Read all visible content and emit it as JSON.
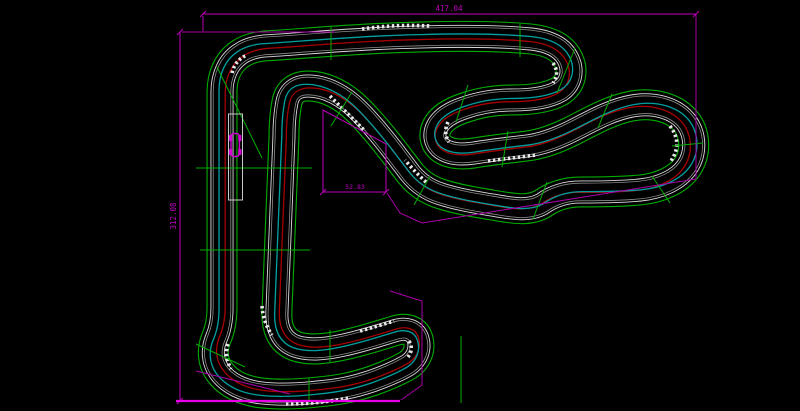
{
  "app": {
    "view": "cad-track-drawing",
    "description_of_view": "black CAD canvas with karting circuit plan, magenta dimensions and green section lines"
  },
  "dimensions": {
    "top_width_label": "417.04",
    "left_height_label": "312.08",
    "inner_width_label": "52.83"
  },
  "colors": {
    "background": "#000000",
    "dimension_magenta": "#be00be",
    "boundary_magenta": "#a800a8",
    "highlight_magenta": "#e800e8",
    "section_green": "#00ae00",
    "track_wall_white": "#dcdcdc",
    "track_wall_gray": "#8c8c8c",
    "racing_line_red": "#a80000",
    "racing_line_cyan": "#00a0a0",
    "kerb_white": "#e8e8e8",
    "kart_magenta": "#d400d4",
    "pit_box_white": "#c8c8c8"
  }
}
